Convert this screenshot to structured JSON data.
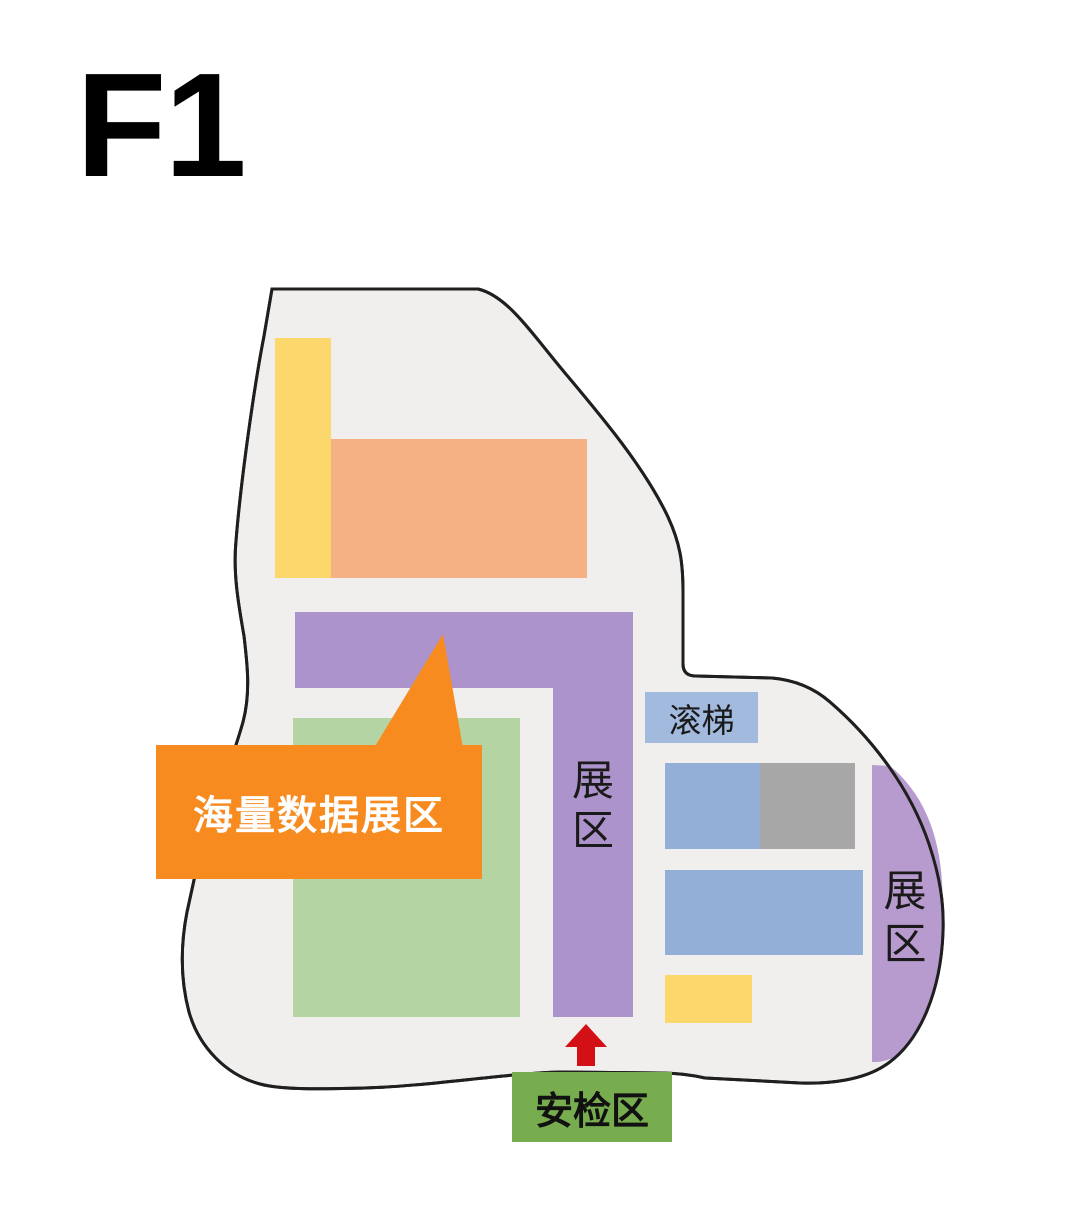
{
  "floor_label": "F1",
  "map": {
    "callout": {
      "label": "海量数据展区"
    },
    "corridor_area": {
      "label": "展区"
    },
    "right_area": {
      "label": "展区"
    },
    "escalator": {
      "label": "滚梯"
    },
    "security": {
      "label": "安检区"
    }
  },
  "colors": {
    "floor_fill": "#f0efee",
    "outline": "#1f1f1f",
    "yellow_zone": "#fcd76b",
    "peach_zone": "#f5b183",
    "corridor_purple": "#ad93cb",
    "right_purple": "#b79bce",
    "green_zone": "#b5d4a4",
    "escalator_blue": "#a3badf",
    "blue_zone": "#93afd8",
    "gray_zone": "#a7a7a7",
    "yellow_small_zone": "#fcd76b",
    "callout_orange": "#f78b1f",
    "callout_text": "#ffffff",
    "arrow_red": "#d21016",
    "security_green": "#77ad4e",
    "label_text": "#1a1a1a"
  }
}
